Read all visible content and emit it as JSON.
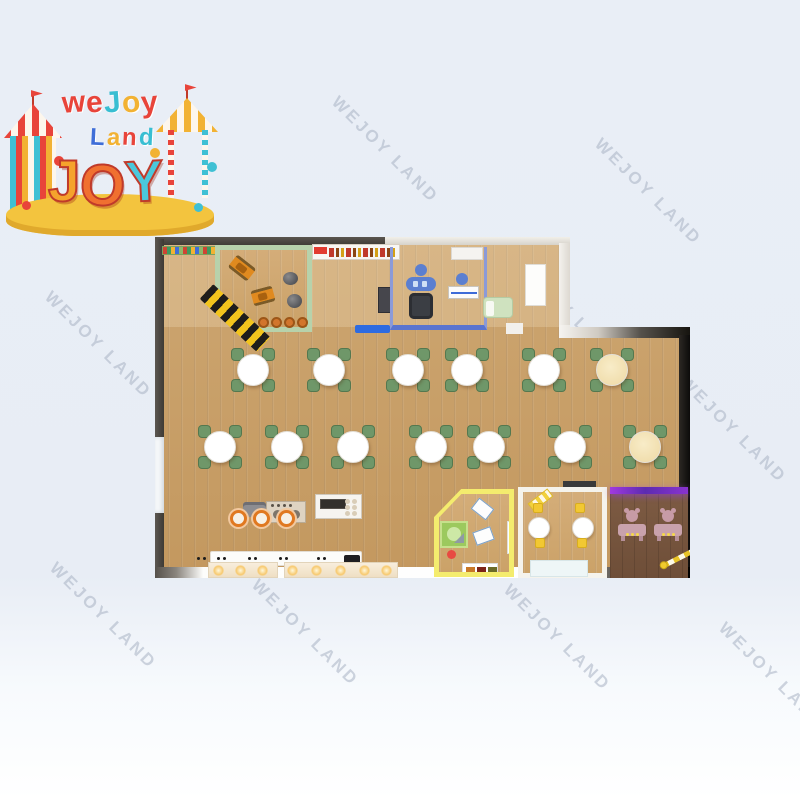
{
  "watermark": {
    "text": "WEJOY LAND",
    "color": "#a9b3c4",
    "angle_deg": 45,
    "positions": [
      [
        385,
        150
      ],
      [
        648,
        192
      ],
      [
        98,
        345
      ],
      [
        218,
        318
      ],
      [
        568,
        312
      ],
      [
        393,
        478
      ],
      [
        733,
        430
      ],
      [
        103,
        616
      ],
      [
        305,
        633
      ],
      [
        557,
        638
      ],
      [
        772,
        676
      ]
    ]
  },
  "logo": {
    "word1": {
      "letters": [
        "w",
        "e",
        "J",
        "o",
        "y"
      ],
      "colors": [
        "#e8443a",
        "#e8443a",
        "#38bed2",
        "#f2b233",
        "#e8443a"
      ]
    },
    "word2": {
      "letters": [
        "L",
        "a",
        "n",
        "d"
      ],
      "colors": [
        "#3f6ed8",
        "#f2b233",
        "#e8443a",
        "#38bed2"
      ]
    },
    "word3": {
      "letters": [
        "J",
        "O",
        "Y"
      ],
      "colors": [
        "#f5a32c",
        "#f07030",
        "#4ac8dc"
      ]
    }
  },
  "floorplan": {
    "wood_color": "#c9a06c",
    "wall_dark": "#4a4540",
    "accent_colors": {
      "green_room": "#b7d2ab",
      "office_blue": "#8b9ad8",
      "craft_yellow": "#f4ec6e",
      "party_white": "#f5f3ec",
      "salon_purple": "#8d2fd6",
      "hazard_yellow": "#f2c41d",
      "chair_green": "#6f9769",
      "stool_orange": "#d2752c",
      "mat_blue": "#2e6be0"
    },
    "dining_rows": [
      {
        "y": 370,
        "tables": [
          {
            "x": 253
          },
          {
            "x": 329
          },
          {
            "x": 408
          },
          {
            "x": 467
          },
          {
            "x": 544
          },
          {
            "x": 612,
            "warm": true
          }
        ]
      },
      {
        "y": 447,
        "tables": [
          {
            "x": 220
          },
          {
            "x": 287
          },
          {
            "x": 353
          },
          {
            "x": 431
          },
          {
            "x": 489
          },
          {
            "x": 570
          },
          {
            "x": 645,
            "warm": true
          }
        ]
      }
    ],
    "play_stools": {
      "y": 322,
      "xs": [
        263,
        276,
        289,
        302
      ]
    },
    "burners": {
      "y": 518,
      "xs": [
        238,
        261,
        286
      ]
    },
    "display_lights": {
      "y": 570,
      "xs": [
        218,
        240,
        262,
        292,
        316,
        340,
        364,
        386
      ]
    },
    "counter_dot_pairs": {
      "y": 557,
      "xs": [
        197,
        217,
        248,
        279,
        317
      ]
    }
  }
}
